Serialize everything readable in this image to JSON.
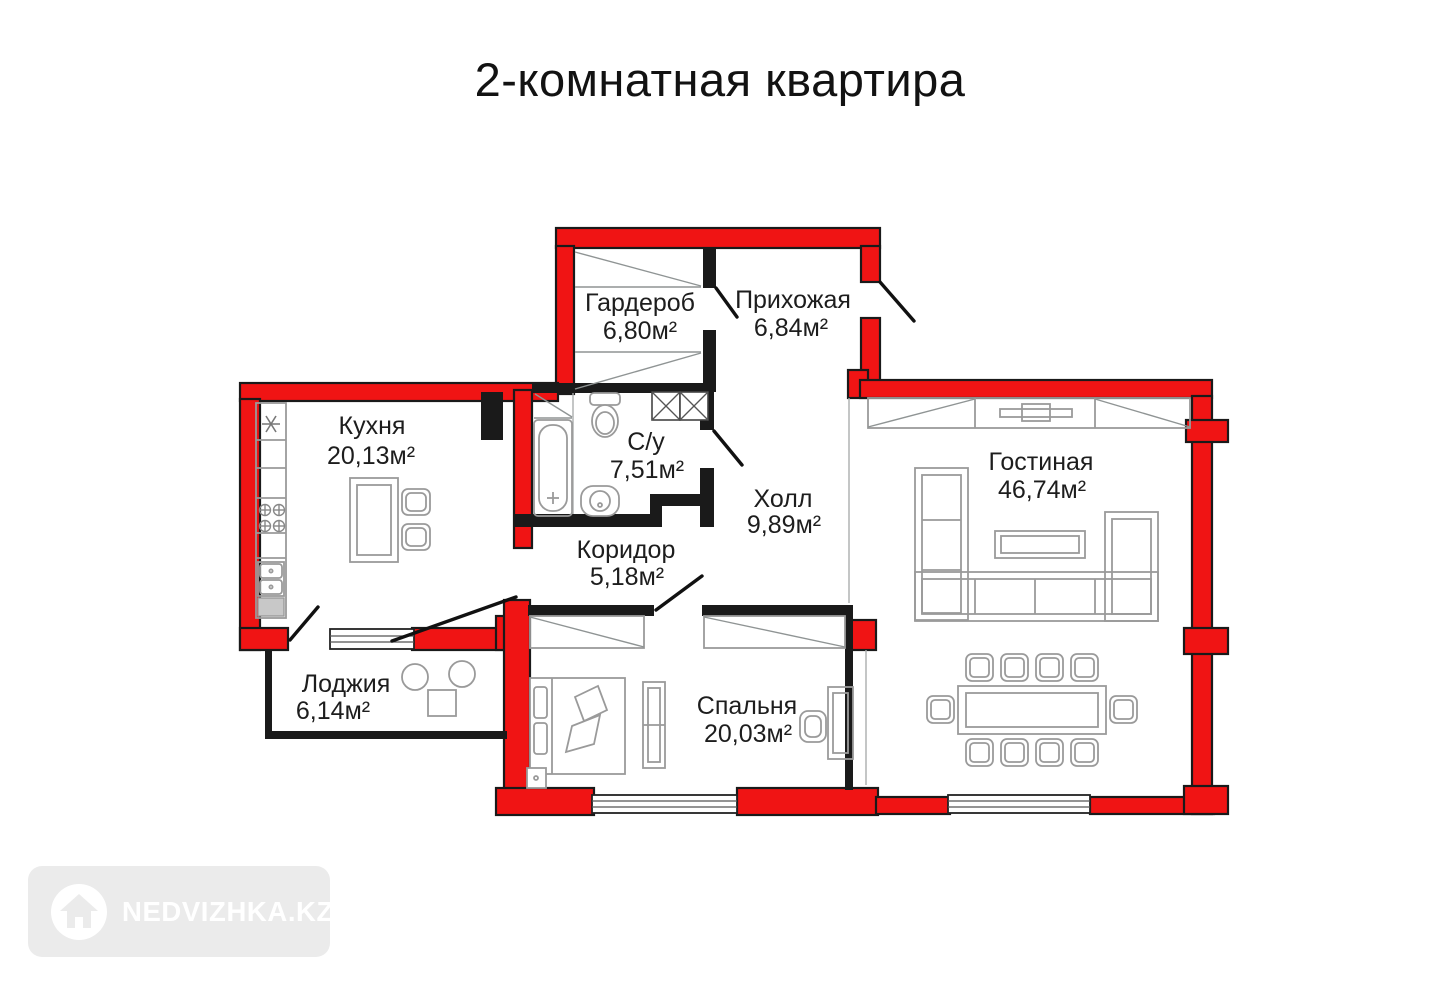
{
  "title": "2-комнатная квартира",
  "watermark": {
    "brand": "NEDVIZHKA.KZ",
    "icon": "house-icon"
  },
  "plan": {
    "rooms": {
      "wardrobe": {
        "name": "Гардероб",
        "area": "6,80м²"
      },
      "entry_hall": {
        "name": "Прихожая",
        "area": "6,84м²"
      },
      "kitchen": {
        "name": "Кухня",
        "area": "20,13м²"
      },
      "bathroom": {
        "name": "С/у",
        "area": "7,51м²"
      },
      "hall": {
        "name": "Холл",
        "area": "9,89м²"
      },
      "living_room": {
        "name": "Гостиная",
        "area": "46,74м²"
      },
      "corridor": {
        "name": "Коридор",
        "area": "5,18м²"
      },
      "loggia": {
        "name": "Лоджия",
        "area": "6,14м²"
      },
      "bedroom": {
        "name": "Спальня",
        "area": "20,03м²"
      }
    },
    "colors": {
      "load_bearing_wall": "#f01414",
      "partition_wall": "#1a1a1a",
      "furniture_outline": "#9a9a9a"
    }
  }
}
